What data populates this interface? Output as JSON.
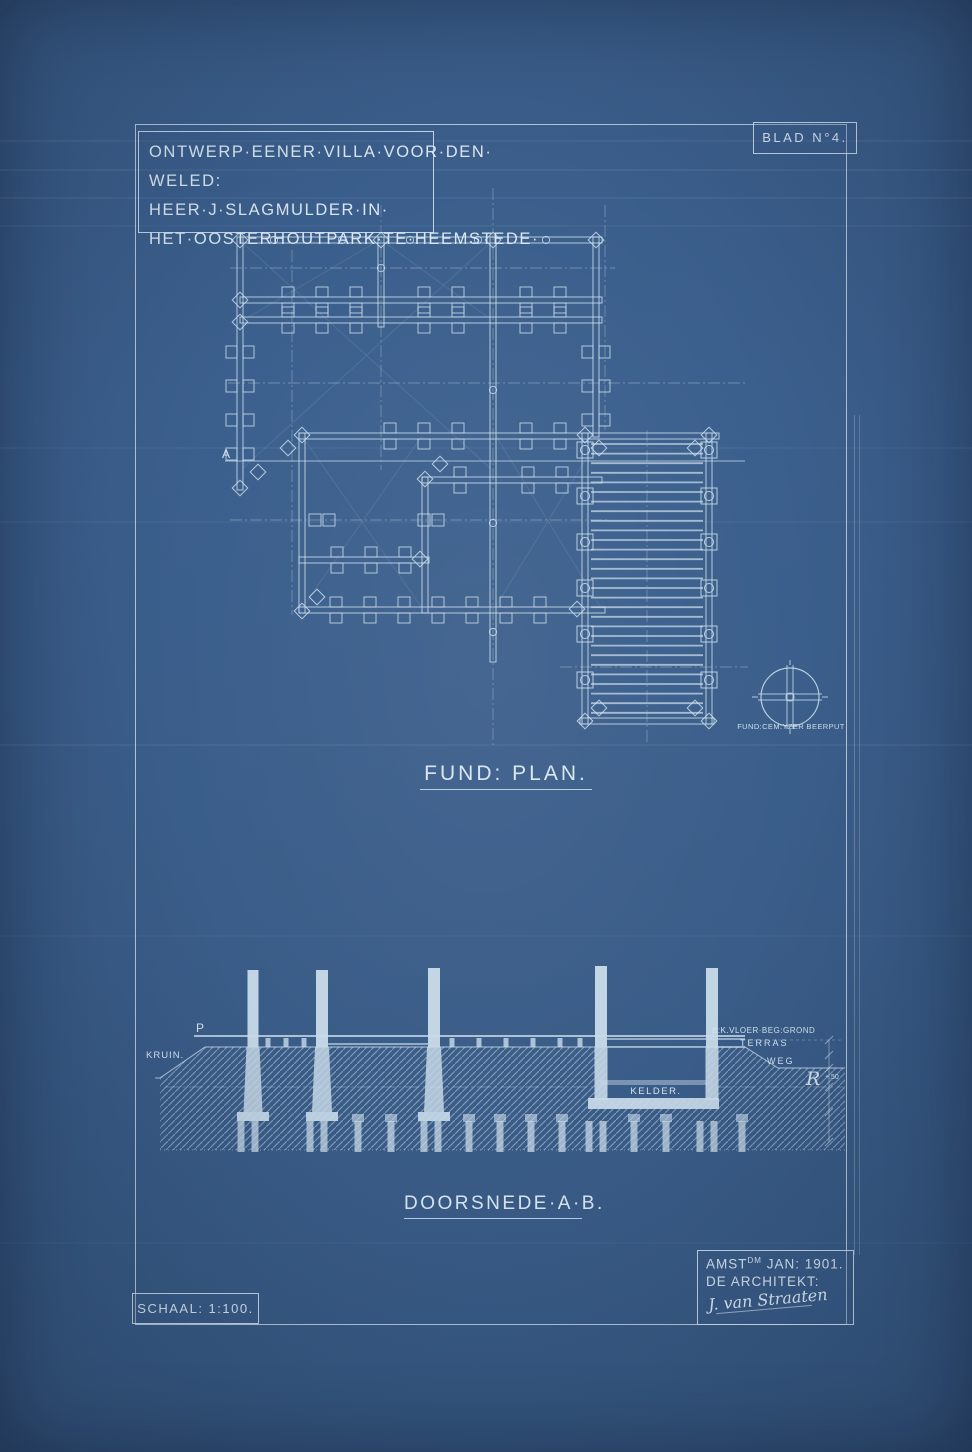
{
  "colors": {
    "paper": "#3a5d89",
    "line": "#cfe0ed",
    "text": "#d9e6f1"
  },
  "title_block": {
    "line1": "ONTWERP·EENER·VILLA·VOOR·DEN·",
    "line2": "WELED: HEER·J·SLAGMULDER·IN·",
    "line3": "HET·OOSTERHOUTPARK·TE·HEEMSTEDE·"
  },
  "sheet": {
    "blad": "BLAD N°4.",
    "schaal": "SCHAAL: 1:100."
  },
  "plan": {
    "caption": "FUND: PLAN.",
    "marker_a": "A",
    "beerput_label": "FUND:CEM:YZER BEERPUT"
  },
  "section": {
    "caption": "DOORSNEDE·A·B.",
    "p": "P",
    "kruin": "KRUIN.",
    "vloer": "B:K.VLOER·BEG:GROND",
    "terras": "TERRAS",
    "weg": "WEG",
    "kelder": "KELDER.",
    "datum": "R",
    "datum_value": "+.50"
  },
  "colophon": {
    "city": "AMST",
    "city_sup": "DM",
    "date": " JAN: 1901.",
    "architect": "DE ARCHITEKT:",
    "signature": "J. van Straaten"
  }
}
